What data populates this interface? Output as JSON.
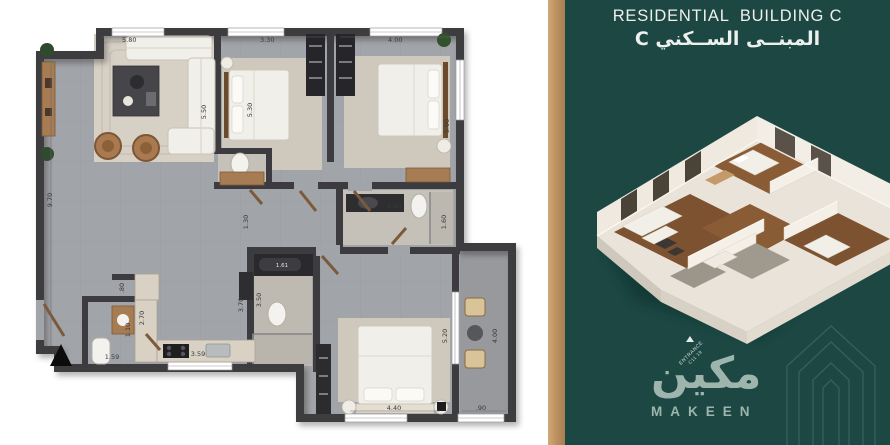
{
  "header": {
    "title_en": "RESIDENTIAL  BUILDING C",
    "title_ar": "المبنــى الســكني C"
  },
  "badge": {
    "line1": "ENTRANCE",
    "line2": "C11 19"
  },
  "brand": {
    "logo_ar": "مكين",
    "logo_en": "MAKEEN"
  },
  "plan": {
    "dims": {
      "living_w": "5.80",
      "living_d": "5.50",
      "hall_d": "9.70",
      "bed2_w": "3.30",
      "bed2_d": "5.30",
      "bed3_w": "4.00",
      "bed3_d": "5.00",
      "bath1_w": "2.60",
      "bath1_d": "1.60",
      "corridor": "1.30",
      "bath2_w": "1.61",
      "kitchen_d": "2.70",
      "kitchen_w": "3.59",
      "niche": ".80",
      "wc_w": "1.59",
      "wc_d": "1.10",
      "hall2_d": "3.70",
      "hall3_d": "3.50",
      "master_w": "4.40",
      "master_d": "5.20",
      "balcony_d": "4.00",
      "balcony_w": ".90"
    }
  },
  "colors": {
    "panel_bg": "#1C4743",
    "divider": "#C49A6B",
    "title": "#EEF0EE",
    "logo": "#9DB5AC",
    "watermark": "#35625C",
    "wall": "#3C3C40",
    "floor": "#A1A4A8",
    "rug": "#D6D0C5",
    "wood": "#A87C52",
    "furniture_white": "#F1EFE9"
  }
}
